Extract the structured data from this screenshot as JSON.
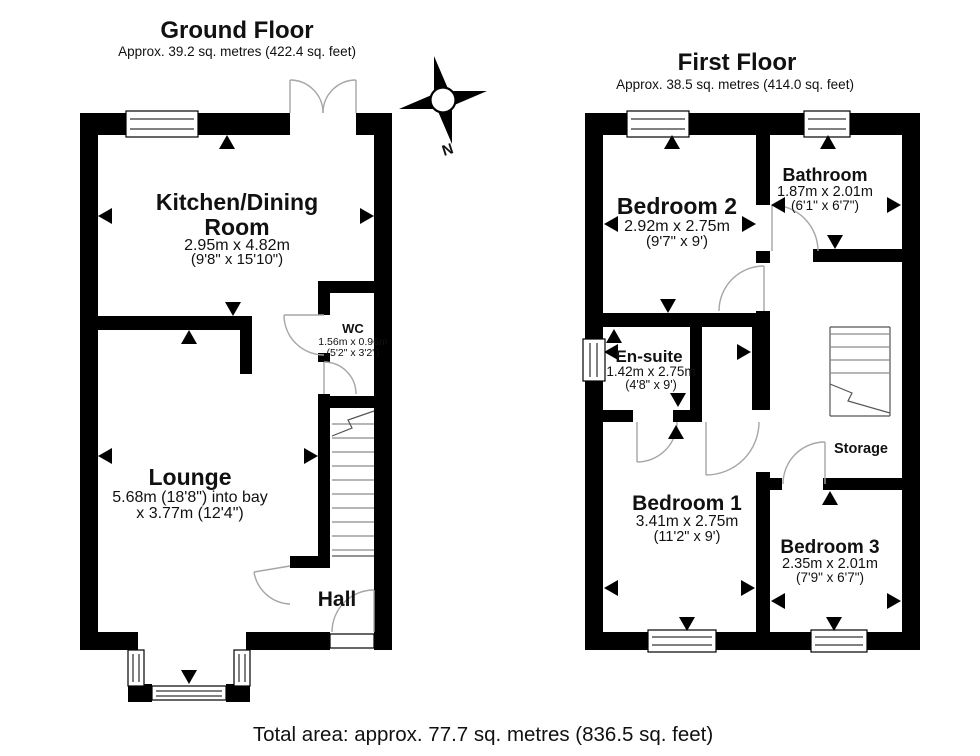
{
  "ground_floor": {
    "title": "Ground Floor",
    "subtitle": "Approx. 39.2 sq. metres (422.4 sq. feet)",
    "rooms": {
      "kitchen_dining": {
        "name1": "Kitchen/Dining",
        "name2": "Room",
        "dims_metric": "2.95m x 4.82m",
        "dims_imperial": "(9'8\" x 15'10\")"
      },
      "wc": {
        "name": "WC",
        "dims_metric": "1.56m x 0.96m",
        "dims_imperial": "(5'2\" x 3'2\")"
      },
      "lounge": {
        "name": "Lounge",
        "dims_line1": "5.68m (18'8\") into bay",
        "dims_line2": "x 3.77m (12'4\")"
      },
      "hall": {
        "name": "Hall"
      }
    }
  },
  "first_floor": {
    "title": "First Floor",
    "subtitle": "Approx. 38.5 sq. metres (414.0 sq. feet)",
    "rooms": {
      "bedroom_2": {
        "name": "Bedroom 2",
        "dims_metric": "2.92m x 2.75m",
        "dims_imperial": "(9'7\" x 9')"
      },
      "bathroom": {
        "name": "Bathroom",
        "dims_metric": "1.87m x 2.01m",
        "dims_imperial": "(6'1\" x 6'7\")"
      },
      "en_suite": {
        "name": "En-suite",
        "dims_metric": "1.42m x 2.75m",
        "dims_imperial": "(4'8\" x 9')"
      },
      "bedroom_1": {
        "name": "Bedroom 1",
        "dims_metric": "3.41m x 2.75m",
        "dims_imperial": "(11'2\" x 9')"
      },
      "bedroom_3": {
        "name": "Bedroom 3",
        "dims_metric": "2.35m x 2.01m",
        "dims_imperial": "(7'9\" x 6'7\")"
      },
      "storage": {
        "name": "Storage"
      }
    }
  },
  "compass": {
    "north_label": "N"
  },
  "footer": {
    "total_area": "Total area: approx. 77.7 sq. metres (836.5 sq. feet)"
  },
  "colors": {
    "wall": "#000000",
    "background": "#ffffff",
    "door_arc": "#a6a6a6",
    "text": "#111111"
  }
}
